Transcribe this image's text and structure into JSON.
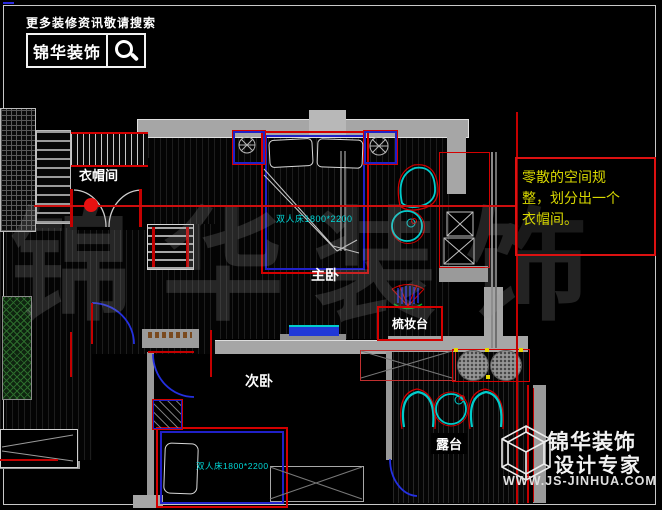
{
  "header": {
    "promo": "更多装修资讯敬请搜索",
    "brand": "锦华装饰"
  },
  "annotation": {
    "line1": "零散的空间规",
    "line2": "整，划分出一个",
    "line3": "衣帽间。",
    "text_color": "#d8d800",
    "box_color": "#dd1111"
  },
  "rooms": {
    "cloakroom": "衣帽间",
    "master": "主卧",
    "dresser": "梳妆台",
    "second": "次卧",
    "terrace": "露台"
  },
  "furniture": {
    "master_bed": "双人床1800*2200",
    "second_bed": "双人床1800*2200"
  },
  "logo": {
    "brand": "锦华装饰",
    "tagline": "设计专家",
    "url": "WWW.JS-JINHUA.COM"
  },
  "watermark": "锦华装饰",
  "colors": {
    "cad_red": "#d40000",
    "cad_blue": "#2020c8",
    "cad_cyan": "#00cccc",
    "wall_gray": "#a6a6a6",
    "annotation_yellow": "#d8d800"
  }
}
